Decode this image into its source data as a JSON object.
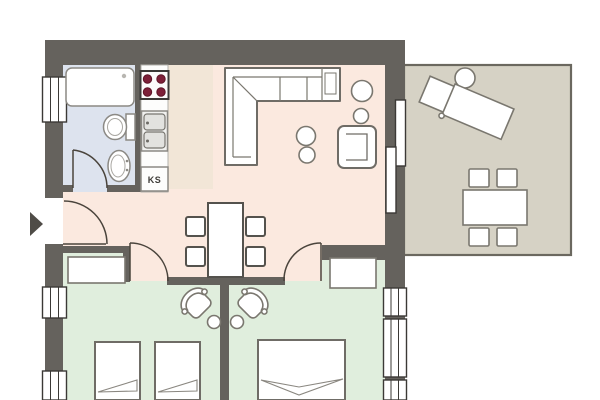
{
  "plan": {
    "labels": {
      "fridge": "KS"
    },
    "colors": {
      "wall": "#65625d",
      "living": "#fbe9df",
      "kitchen": "#f2e6d7",
      "bathroom": "#dde3ee",
      "bedroom": "#e0eedd",
      "terrace": "#d6d2c5",
      "terrace_border": "#6b685f",
      "burner": "#7d2038",
      "arrow": "#4f4c47",
      "background": "#ffffff"
    }
  }
}
